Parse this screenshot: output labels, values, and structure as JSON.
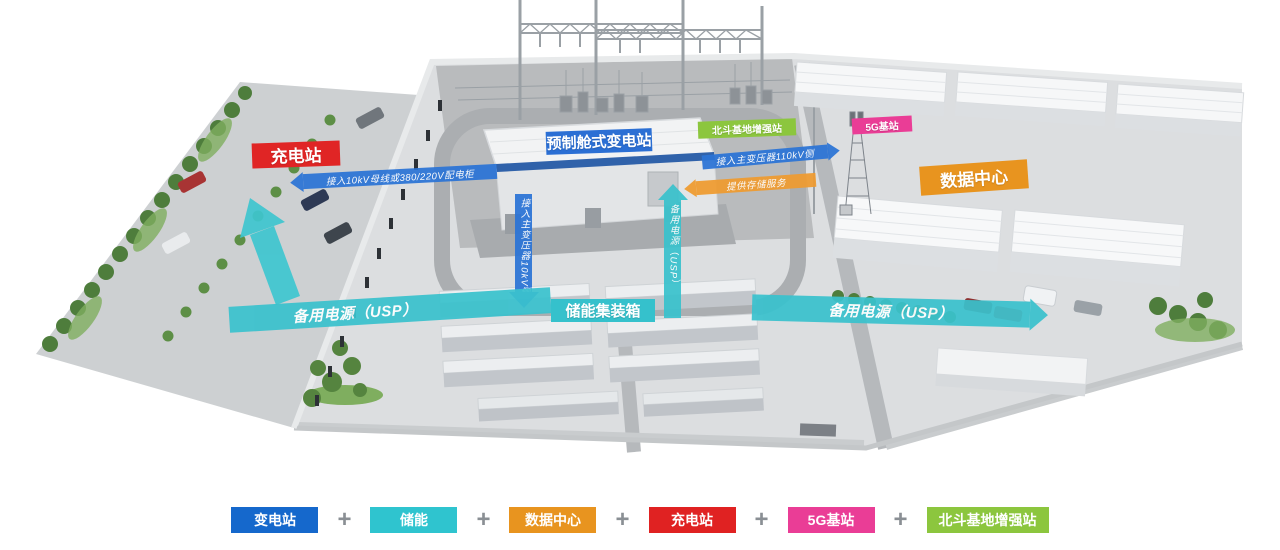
{
  "scene": {
    "labels": {
      "substation": "预制舱式变电站",
      "charging_station": "充电站",
      "data_center": "数据中心",
      "energy_storage": "储能集装箱",
      "g5_station": "5G基站",
      "beidou_station": "北斗基地增强站"
    },
    "arrows": {
      "charging_feed": "接入10kV母线或380/220V配电柜",
      "kv110_feed": "接入主变压器110kV侧",
      "storage_service": "提供存储服务",
      "kv10_feed": "接入主变压器10kV侧",
      "ups_vertical": "备用电源（USP）",
      "ups_left": "备用电源（USP）",
      "ups_right": "备用电源（USP）"
    },
    "colors": {
      "blue": "#2b74d6",
      "cyan": "#3ac2cd",
      "orange": "#ef9b30",
      "label_red": "#e02525",
      "label_blue": "#2b6fd4",
      "label_orange": "#e8941f",
      "label_cyan": "#35c1cc",
      "label_pink": "#ea3d96",
      "label_green": "#8cc63e"
    }
  },
  "legend": {
    "separator": "+",
    "items": [
      {
        "label": "变电站",
        "color": "#1568cc"
      },
      {
        "label": "储能",
        "color": "#2fc4cf"
      },
      {
        "label": "数据中心",
        "color": "#e8941f"
      },
      {
        "label": "充电站",
        "color": "#e02222"
      },
      {
        "label": "5G基站",
        "color": "#ea3d96"
      },
      {
        "label": "北斗基地增强站",
        "color": "#8cc63e"
      }
    ]
  }
}
